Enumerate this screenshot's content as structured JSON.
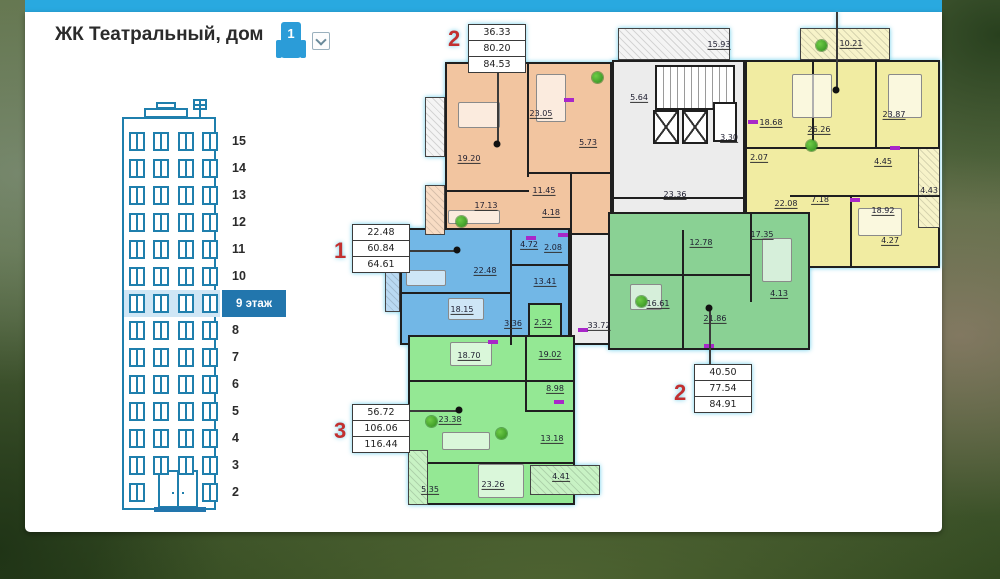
{
  "icons": {
    "dropdown": "chevron-down-icon",
    "building": "building-icon",
    "plants": "plant-icon",
    "elevator": "elevator-shaft",
    "stairs": "staircase"
  },
  "header": {
    "title": "ЖК Театральный, дом",
    "building_number": "1"
  },
  "floor_selector": {
    "selected_label": "9 этаж",
    "selected_index": 6,
    "floors": [
      "15",
      "14",
      "13",
      "12",
      "11",
      "10",
      "9 этаж",
      "8",
      "7",
      "6",
      "5",
      "4",
      "3",
      "2"
    ]
  },
  "floorplan": {
    "colors": {
      "top_bar_blue": "#29a9e0",
      "diagram_blue": "#1f7fad",
      "selected_floor_bg": "#2276ad",
      "selected_floor_band": "#cfe6f5",
      "apartment_orange": "#f2c5a0",
      "apartment_yellow": "#f1eca2",
      "apartment_blue": "#72b7e6",
      "apartment_green_dark": "#8ad194",
      "apartment_green_light": "#94e894",
      "core_gray": "#ececec",
      "wall_black": "#1f1f1f",
      "callout_red": "#c23030",
      "outline_cyan": "#7fd4e8",
      "plant_green": "#3fa32a",
      "marker_purple": "#a827c9"
    },
    "unit_callouts": [
      {
        "number": "2",
        "areas": [
          "36.33",
          "80.20",
          "84.53"
        ],
        "num_pos": {
          "x": 118,
          "y": 14
        },
        "table_pos": {
          "x": 138,
          "y": 12
        },
        "line": {
          "x1": 167,
          "y1": 59,
          "x2": 167,
          "y2": 132
        },
        "dot": {
          "x": 167,
          "y": 132
        }
      },
      {
        "number": "1",
        "areas": [
          "22.48",
          "60.84",
          "64.61"
        ],
        "num_pos": {
          "x": 4,
          "y": 226
        },
        "table_pos": {
          "x": 22,
          "y": 212
        },
        "line": {
          "x1": 80,
          "y1": 238,
          "x2": 127,
          "y2": 238
        },
        "dot": {
          "x": 127,
          "y": 238
        }
      },
      {
        "number": "3",
        "areas": [
          "56.72",
          "106.06",
          "116.44"
        ],
        "num_pos": {
          "x": 4,
          "y": 406
        },
        "table_pos": {
          "x": 22,
          "y": 392
        },
        "line": {
          "x1": 80,
          "y1": 398,
          "x2": 129,
          "y2": 398
        },
        "dot": {
          "x": 129,
          "y": 398
        }
      },
      {
        "number": "2",
        "areas": [
          "40.50",
          "77.54",
          "84.91"
        ],
        "num_pos": {
          "x": 344,
          "y": 368
        },
        "table_pos": {
          "x": 364,
          "y": 352
        },
        "line": {
          "x1": 379,
          "y1": 296,
          "x2": 379,
          "y2": 352
        },
        "dot": {
          "x": 379,
          "y": 296
        }
      }
    ],
    "partial_callout": {
      "line": {
        "x1": 506,
        "y1": 0,
        "x2": 506,
        "y2": 78
      },
      "dot": {
        "x": 506,
        "y": 78
      }
    },
    "room_labels": [
      {
        "text": "23.05",
        "x": 211,
        "y": 102
      },
      {
        "text": "19.20",
        "x": 139,
        "y": 147
      },
      {
        "text": "17.13",
        "x": 156,
        "y": 194
      },
      {
        "text": "11.45",
        "x": 214,
        "y": 179
      },
      {
        "text": "4.18",
        "x": 221,
        "y": 201
      },
      {
        "text": "5.73",
        "x": 258,
        "y": 131
      },
      {
        "text": "15.93",
        "x": 389,
        "y": 33
      },
      {
        "text": "5.64",
        "x": 309,
        "y": 86
      },
      {
        "text": "3.30",
        "x": 399,
        "y": 126
      },
      {
        "text": "23.36",
        "x": 345,
        "y": 183
      },
      {
        "text": "33.72",
        "x": 269,
        "y": 314
      },
      {
        "text": "10.21",
        "x": 521,
        "y": 32
      },
      {
        "text": "26.26",
        "x": 489,
        "y": 118
      },
      {
        "text": "23.87",
        "x": 564,
        "y": 103
      },
      {
        "text": "18.68",
        "x": 441,
        "y": 111
      },
      {
        "text": "2.07",
        "x": 429,
        "y": 146
      },
      {
        "text": "4.45",
        "x": 553,
        "y": 150
      },
      {
        "text": "7.18",
        "x": 490,
        "y": 188
      },
      {
        "text": "18.92",
        "x": 553,
        "y": 199
      },
      {
        "text": "4.27",
        "x": 560,
        "y": 229
      },
      {
        "text": "22.08",
        "x": 456,
        "y": 192
      },
      {
        "text": "4.43",
        "x": 599,
        "y": 179
      },
      {
        "text": "22.48",
        "x": 155,
        "y": 259
      },
      {
        "text": "18.15",
        "x": 132,
        "y": 298
      },
      {
        "text": "13.41",
        "x": 215,
        "y": 270
      },
      {
        "text": "4.72",
        "x": 199,
        "y": 233
      },
      {
        "text": "2.08",
        "x": 223,
        "y": 236
      },
      {
        "text": "3.36",
        "x": 183,
        "y": 312
      },
      {
        "text": "2.52",
        "x": 213,
        "y": 311
      },
      {
        "text": "12.78",
        "x": 371,
        "y": 231
      },
      {
        "text": "17.35",
        "x": 432,
        "y": 223
      },
      {
        "text": "16.61",
        "x": 328,
        "y": 292
      },
      {
        "text": "21.86",
        "x": 385,
        "y": 307
      },
      {
        "text": "4.13",
        "x": 449,
        "y": 282
      },
      {
        "text": "18.70",
        "x": 139,
        "y": 344
      },
      {
        "text": "19.02",
        "x": 220,
        "y": 343
      },
      {
        "text": "8.98",
        "x": 225,
        "y": 377
      },
      {
        "text": "23.38",
        "x": 120,
        "y": 408
      },
      {
        "text": "13.18",
        "x": 222,
        "y": 427
      },
      {
        "text": "23.26",
        "x": 163,
        "y": 473
      },
      {
        "text": "5.35",
        "x": 100,
        "y": 478
      },
      {
        "text": "4.41",
        "x": 231,
        "y": 465
      }
    ]
  }
}
